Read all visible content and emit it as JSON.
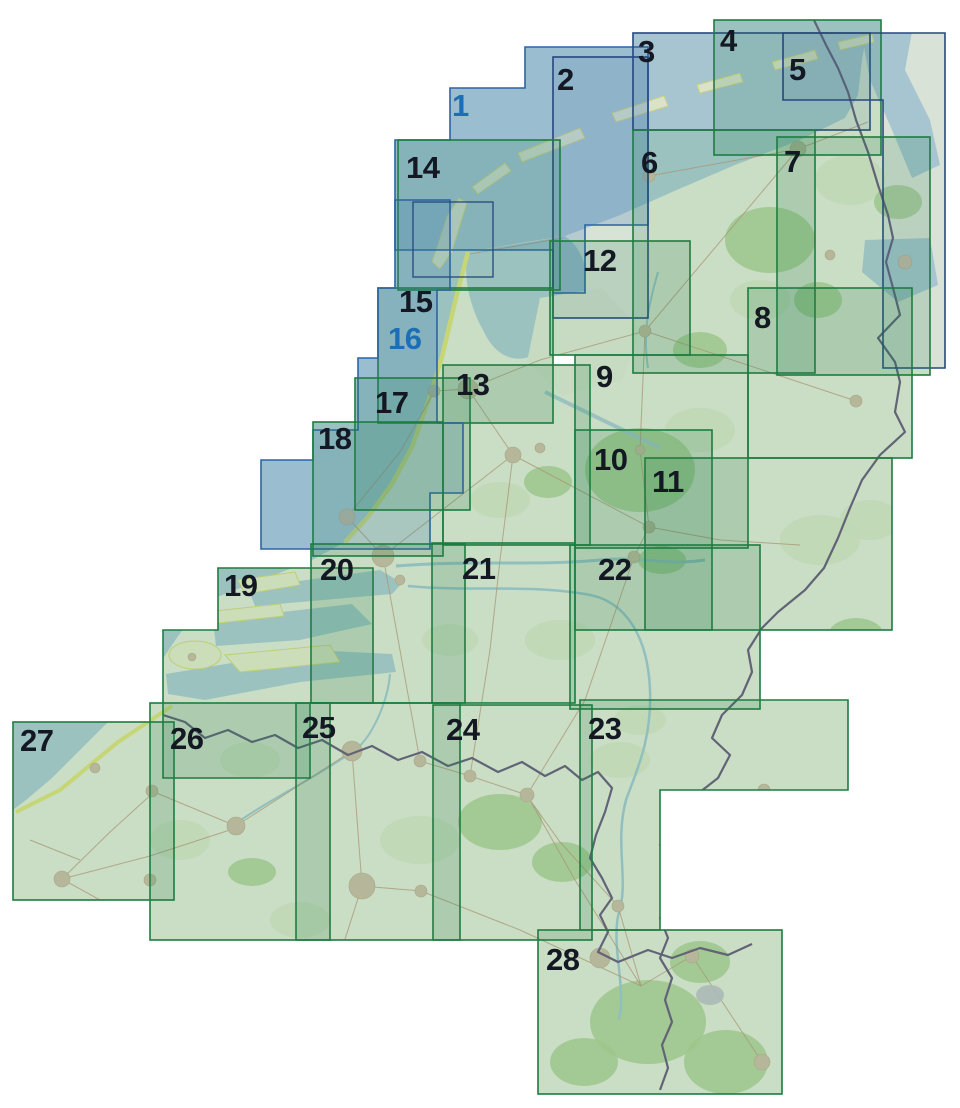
{
  "map_index": {
    "palette": {
      "background": "#ffffff",
      "sea": "#b5d1d8",
      "land": "#edf1df",
      "forest": "#b6d69b",
      "dune": "#e9e87e",
      "border_line": "#6f5e80",
      "sheet_green_stroke": "#1e7c40",
      "sheet_navy_stroke": "#26477c",
      "sheet_water_stroke": "#2d63a5",
      "label_dark": "#131823",
      "label_blue": "#1c6fb4"
    },
    "sheets": [
      {
        "num": "1",
        "style": "water",
        "shape": "poly",
        "points": "525,47 648,47 648,225 585,225 585,293 553,293 553,250 395,250 395,140 450,140 450,88 525,88",
        "lx": 452,
        "ly": 116
      },
      {
        "num": "2",
        "style": "navy",
        "shape": "rect",
        "x": 553,
        "y": 57,
        "w": 95,
        "h": 261,
        "lx": 557,
        "ly": 90
      },
      {
        "num": "3",
        "style": "navy",
        "shape": "rect",
        "x": 633,
        "y": 33,
        "w": 237,
        "h": 97,
        "lx": 638,
        "ly": 62
      },
      {
        "num": "4",
        "style": "green",
        "shape": "rect",
        "x": 714,
        "y": 20,
        "w": 167,
        "h": 135,
        "lx": 720,
        "ly": 51
      },
      {
        "num": "5",
        "style": "navy",
        "shape": "poly",
        "points": "783,33 945,33 945,368 883,368 883,100 783,100",
        "lx": 789,
        "ly": 80
      },
      {
        "num": "6",
        "style": "green",
        "shape": "rect",
        "x": 633,
        "y": 130,
        "w": 182,
        "h": 243,
        "lx": 641,
        "ly": 173
      },
      {
        "num": "7",
        "style": "green",
        "shape": "rect",
        "x": 777,
        "y": 137,
        "w": 153,
        "h": 238,
        "lx": 784,
        "ly": 172
      },
      {
        "num": "8",
        "style": "green",
        "shape": "rect",
        "x": 748,
        "y": 288,
        "w": 164,
        "h": 170,
        "lx": 754,
        "ly": 328
      },
      {
        "num": "9",
        "style": "green",
        "shape": "rect",
        "x": 575,
        "y": 355,
        "w": 173,
        "h": 193,
        "lx": 596,
        "ly": 387
      },
      {
        "num": "10",
        "style": "green",
        "shape": "rect",
        "x": 575,
        "y": 430,
        "w": 137,
        "h": 200,
        "lx": 594,
        "ly": 470
      },
      {
        "num": "11",
        "style": "green",
        "shape": "rect",
        "x": 645,
        "y": 458,
        "w": 247,
        "h": 172,
        "lx": 652,
        "ly": 492
      },
      {
        "num": "12",
        "style": "green",
        "shape": "rect",
        "x": 550,
        "y": 241,
        "w": 140,
        "h": 114,
        "lx": 583,
        "ly": 271
      },
      {
        "num": "13",
        "style": "green",
        "shape": "rect",
        "x": 443,
        "y": 365,
        "w": 147,
        "h": 180,
        "lx": 456,
        "ly": 395
      },
      {
        "num": "14",
        "style": "green",
        "shape": "rect",
        "x": 398,
        "y": 140,
        "w": 162,
        "h": 150,
        "lx": 406,
        "ly": 178
      },
      {
        "num": "15",
        "style": "green",
        "shape": "rect",
        "x": 378,
        "y": 288,
        "w": 175,
        "h": 135,
        "lx": 399,
        "ly": 312
      },
      {
        "num": "16",
        "style": "water",
        "shape": "poly",
        "points": "395,200 450,200 450,290 437,290 437,423 463,423 463,493 430,493 430,549 261,549 261,460 313,460 313,430 358,430 358,358 378,358 378,288 395,288",
        "lx": 388,
        "ly": 349
      },
      {
        "num": "17",
        "style": "green",
        "shape": "rect",
        "x": 355,
        "y": 378,
        "w": 115,
        "h": 132,
        "lx": 375,
        "ly": 413
      },
      {
        "num": "18",
        "style": "green",
        "shape": "rect",
        "x": 313,
        "y": 422,
        "w": 130,
        "h": 134,
        "lx": 318,
        "ly": 449
      },
      {
        "num": "19",
        "style": "green",
        "shape": "poly",
        "points": "218,568 373,568 373,703 310,703 310,778 163,778 163,630 218,630",
        "lx": 224,
        "ly": 596
      },
      {
        "num": "20",
        "style": "green",
        "shape": "rect",
        "x": 311,
        "y": 544,
        "w": 154,
        "h": 159,
        "lx": 320,
        "ly": 580
      },
      {
        "num": "21",
        "style": "green",
        "shape": "rect",
        "x": 432,
        "y": 543,
        "w": 143,
        "h": 160,
        "lx": 462,
        "ly": 579
      },
      {
        "num": "22",
        "style": "green",
        "shape": "rect",
        "x": 570,
        "y": 545,
        "w": 190,
        "h": 164,
        "lx": 598,
        "ly": 580
      },
      {
        "num": "23",
        "style": "green",
        "shape": "poly",
        "points": "580,700 848,700 848,790 660,790 660,930 580,930",
        "lx": 588,
        "ly": 739
      },
      {
        "num": "24",
        "style": "green",
        "shape": "rect",
        "x": 433,
        "y": 705,
        "w": 159,
        "h": 235,
        "lx": 446,
        "ly": 740
      },
      {
        "num": "25",
        "style": "green",
        "shape": "rect",
        "x": 296,
        "y": 703,
        "w": 164,
        "h": 237,
        "lx": 302,
        "ly": 738
      },
      {
        "num": "26",
        "style": "green",
        "shape": "rect",
        "x": 150,
        "y": 703,
        "w": 180,
        "h": 237,
        "lx": 170,
        "ly": 749
      },
      {
        "num": "27",
        "style": "green",
        "shape": "rect",
        "x": 13,
        "y": 722,
        "w": 161,
        "h": 178,
        "lx": 20,
        "ly": 751
      },
      {
        "num": "28",
        "style": "green",
        "shape": "rect",
        "x": 538,
        "y": 930,
        "w": 244,
        "h": 164,
        "lx": 546,
        "ly": 970
      }
    ],
    "inset_box": {
      "x": 413,
      "y": 202,
      "w": 80,
      "h": 75
    }
  }
}
